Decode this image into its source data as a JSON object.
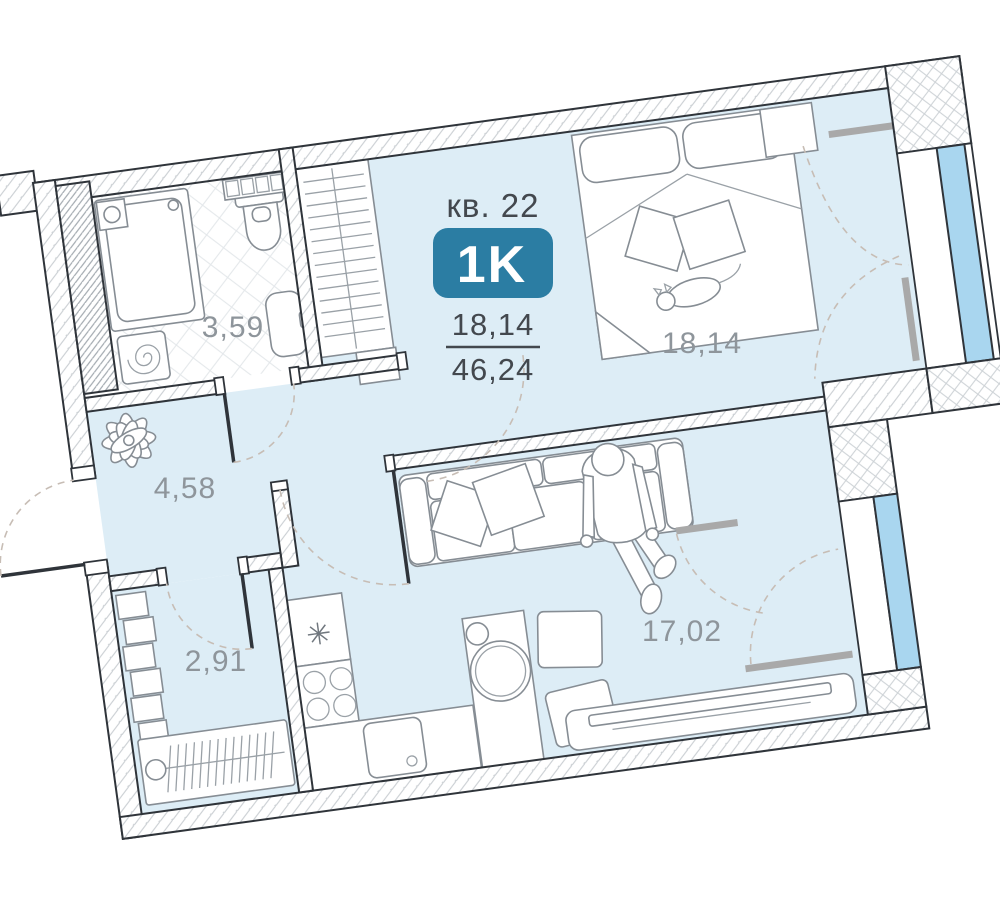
{
  "header": {
    "apartment_label": "кв. 22",
    "type_badge": "1K",
    "living_area": "18,14",
    "total_area": "46,24"
  },
  "rooms": {
    "bathroom": "3,59",
    "hallway": "4,58",
    "closet": "2,91",
    "bedroom": "18,14",
    "kitchen_living": "17,02"
  },
  "icons": {
    "fridge_symbol": "✳"
  },
  "colors": {
    "badge": "#2b7da3",
    "room_fill": "#ddedf6",
    "glass": "#a9d6ef",
    "label_gray": "#8e959b",
    "text_dark": "#43484e",
    "wall": "#2f343a"
  }
}
